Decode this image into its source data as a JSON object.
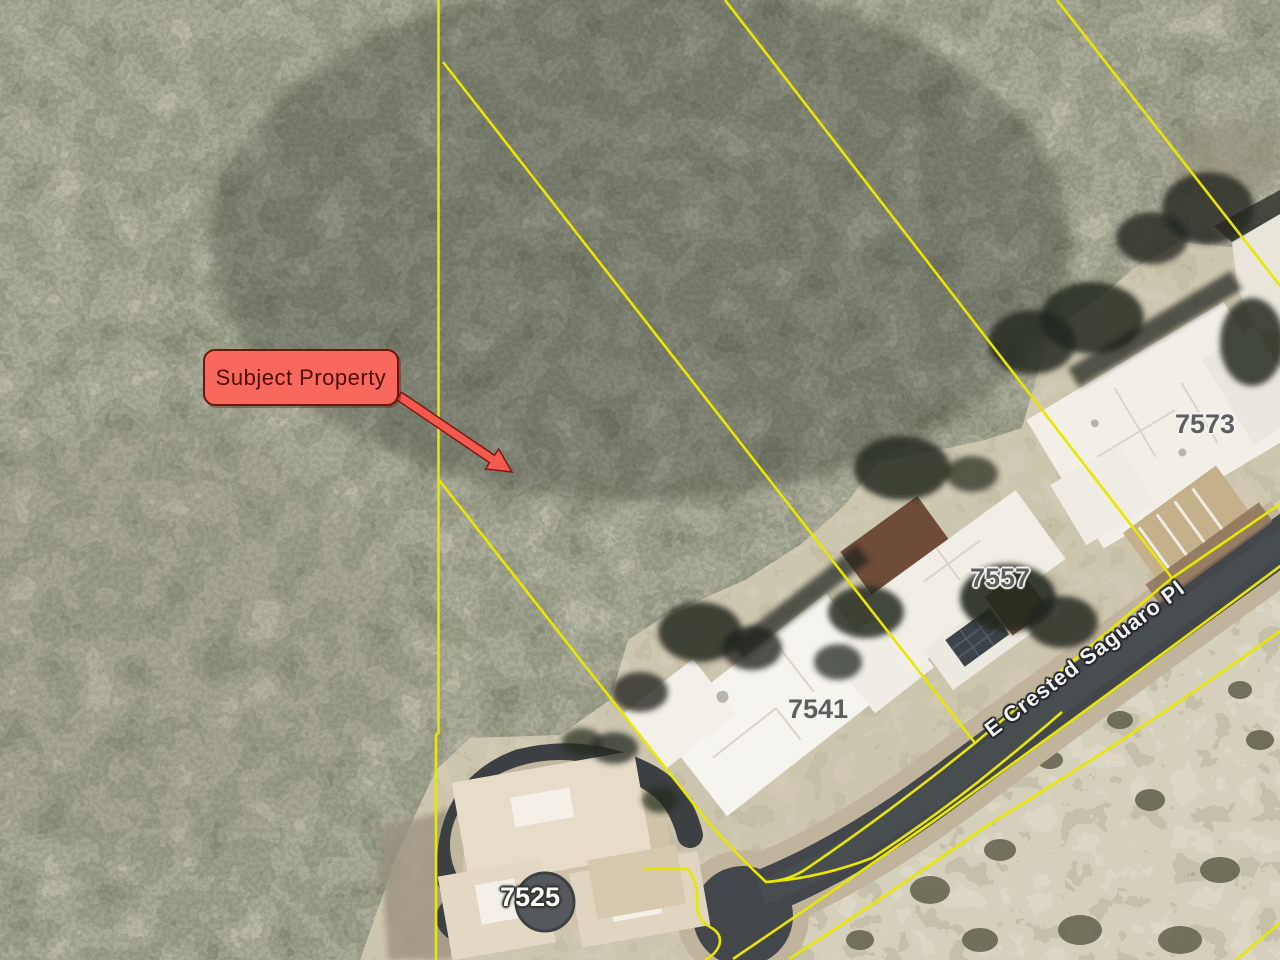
{
  "map": {
    "annotation": {
      "label": "Subject Property"
    },
    "street_label": "E Crested Saguaro Pl",
    "parcel_labels": [
      {
        "house_number": "7525"
      },
      {
        "house_number": "7541"
      },
      {
        "house_number": "7557"
      },
      {
        "house_number": "7573"
      }
    ],
    "colors": {
      "parcel_line": "#e9e600",
      "callout_fill": "#f8685c",
      "callout_border": "#6d150f",
      "road_asphalt": "#43474b",
      "annotation_arrow": "#f4594e"
    }
  }
}
